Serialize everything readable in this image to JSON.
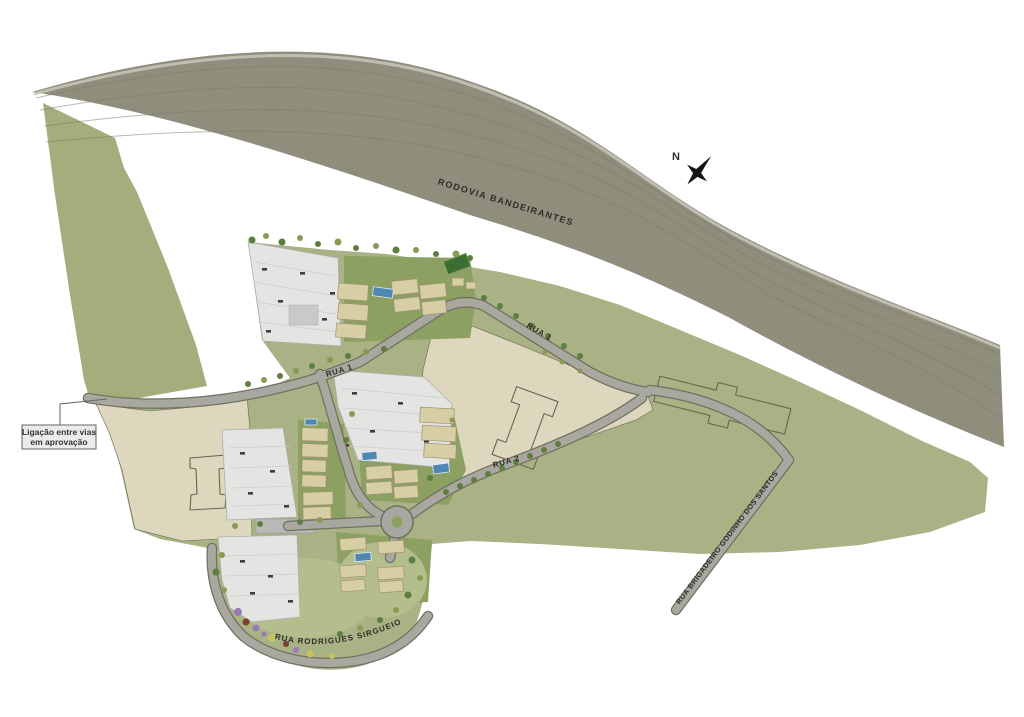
{
  "labels": {
    "highway": "RODOVIA BANDEIRANTES",
    "rua1_east": "RUA 1",
    "rua1_west": "RUA 1",
    "rua2": "RUA 2",
    "rua_brigadeiro": "RUA BRIGADEIRO GODINHO DOS SANTOS",
    "rua_rodrigues": "RUA RODRIGUES SIRGUEIO",
    "compass_n": "N",
    "annotation_line1": "Ligação entre vias",
    "annotation_line2": "em aprovação"
  },
  "theme": {
    "background": "#ffffff",
    "highway_fill": "#8f8d7c",
    "highway_stripe": "#7d7b6a",
    "highway_shoulder": "#c9c7ba",
    "hill_green": "#a4ae7c",
    "field_green": "#a9b284",
    "site_green": "#8ba061",
    "lawn_green": "#b3be8c",
    "lot_beige": "#ddd7bd",
    "outline_dark": "#6b6452",
    "road_fill": "#a8a8a0",
    "road_casing": "#70705f",
    "deck_gray": "#e4e4e2",
    "deck_line": "#cccccb",
    "roof_tan": "#d8cea4",
    "roof_line": "#a09274",
    "pool_blue": "#4f86b4",
    "court_green": "#3c6e33",
    "tree_dark": "#5e7d3f",
    "tree_olive": "#8a9a55",
    "shrub_purple": "#9b79bd",
    "shrub_yellow": "#c9c35e",
    "shrub_rust": "#7c3e2e",
    "label_color": "#2e2e28",
    "callout_bg": "#ebebe9",
    "callout_border": "#666666"
  }
}
